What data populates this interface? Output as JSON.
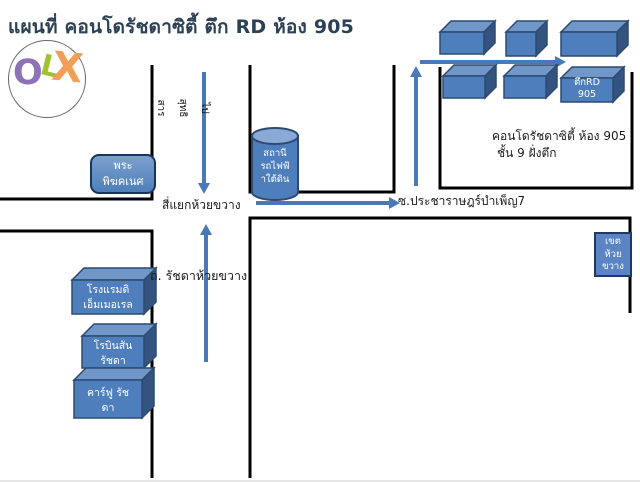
{
  "title": "แผนที่ คอนโดรัชดาซิตี้ ตึก RD ห้อง 905",
  "logo": {
    "letters": [
      {
        "char": "O",
        "color": "#8d72b8"
      },
      {
        "char": "L",
        "color": "#a3c233"
      },
      {
        "char": "X",
        "color": "#f29e57"
      }
    ]
  },
  "map": {
    "street_up_label": {
      "lines": [
        "ไป",
        "สุทธิ",
        "สาร"
      ]
    },
    "intersection_label": "สี่แยกห้วยขวาง",
    "soi_label": "ซ.ประชาราษฎร์บำเพ็ญ7",
    "road_label": "ถ. รัชดาห้วยขวาง",
    "condo_note": {
      "line1": "คอนโดรัชดาซิตี้ ห้อง 905",
      "line2": "ชั้น 9 ฝั่งตึก"
    },
    "places": {
      "shrine": {
        "lines": [
          "พระ",
          "พิฆคเนศ"
        ]
      },
      "station": {
        "lines": [
          "สถานี",
          "รถไฟฟ้",
          "าใต้ดิน"
        ]
      },
      "district": {
        "lines": [
          "เขต",
          "ห้วย",
          "ขวาง"
        ]
      },
      "building_rd": {
        "lines": [
          "ตึกRD",
          "905"
        ]
      },
      "hotel": {
        "lines": [
          "โรงแรมดิ",
          "เอ็มเมอเรล"
        ]
      },
      "robinson": {
        "lines": [
          "โรบินสัน",
          "รัชดา"
        ]
      },
      "carrefour": {
        "lines": [
          "คาร์ฟู รัช",
          "ดา"
        ]
      }
    }
  },
  "colors": {
    "accent_blue": "#4f81bd",
    "arrow_blue": "#4a79b8",
    "road_black": "#000000",
    "title_color": "#2d4154"
  }
}
